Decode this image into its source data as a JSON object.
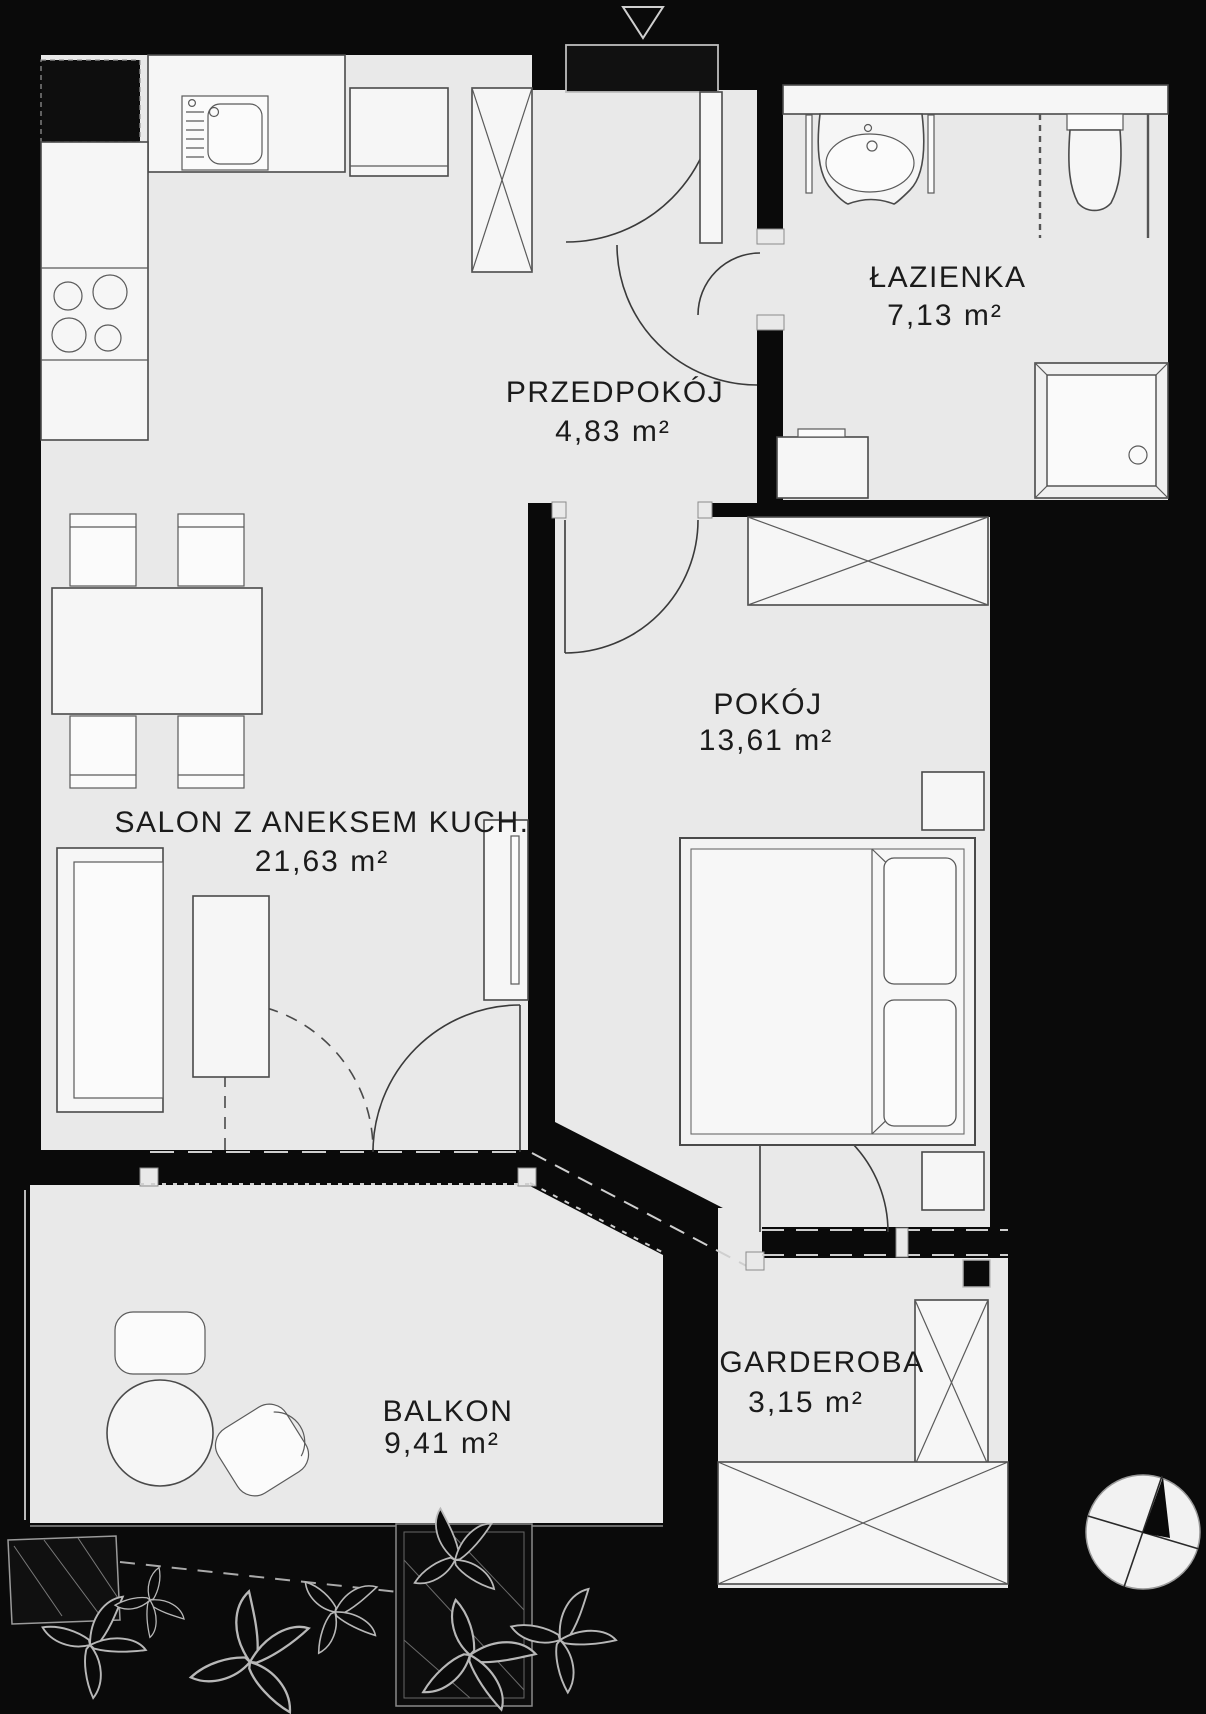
{
  "plan": {
    "title": "apartment-floor-plan",
    "rooms": [
      {
        "id": "przedpokoj",
        "name": "PRZEDPOKÓJ",
        "area": "4,83 m²"
      },
      {
        "id": "lazienka",
        "name": "ŁAZIENKA",
        "area": "7,13 m²"
      },
      {
        "id": "pokoj",
        "name": "POKÓJ",
        "area": "13,61 m²"
      },
      {
        "id": "salon",
        "name": "SALON Z ANEKSEM KUCH.",
        "area": "21,63 m²"
      },
      {
        "id": "balkon",
        "name": "BALKON",
        "area": "9,41 m²"
      },
      {
        "id": "garderoba",
        "name": "GARDEROBA",
        "area": "3,15 m²"
      }
    ],
    "colors": {
      "wall": "#0a0a0a",
      "floor": "#e9e9e9",
      "furniture": "#f6f6f6",
      "line": "#3a3a3a",
      "wall_marking": "#cfcfcf",
      "text": "#1b1b1b"
    },
    "icons": [
      "entrance-arrow-icon",
      "entrance-door-icon",
      "kitchen-sink-icon",
      "stove-icon",
      "fridge-icon",
      "tall-cabinet-icon",
      "hall-closet-icon",
      "washbasin-icon",
      "toilet-icon",
      "shower-icon",
      "washing-machine-icon",
      "wardrobe-icon",
      "bed-icon",
      "pillow-icon",
      "nightstand-icon",
      "dining-table-icon",
      "chair-icon",
      "sofa-icon",
      "coffee-table-icon",
      "tv-cabinet-icon",
      "balcony-table-icon",
      "balcony-chair-icon",
      "planter-icon",
      "plant-icon",
      "compass-icon"
    ]
  }
}
